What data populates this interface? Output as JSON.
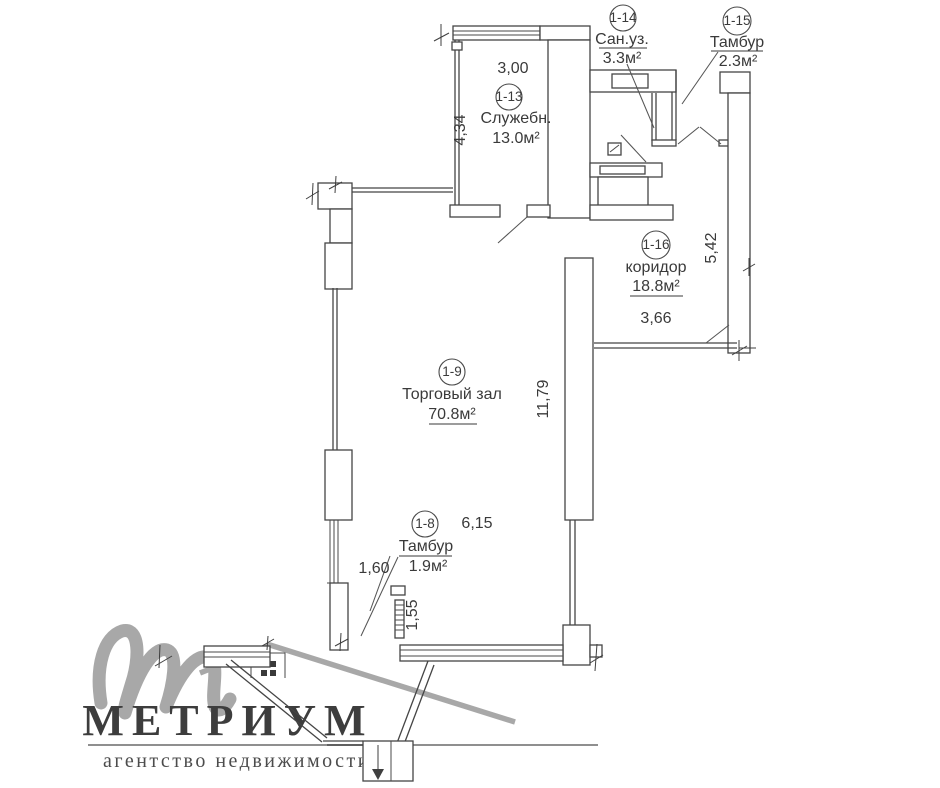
{
  "plan": {
    "rooms": [
      {
        "num": "1-13",
        "name": "Служебн.",
        "area": "13.0м²"
      },
      {
        "num": "1-14",
        "name": "Сан.уз.",
        "area": "3.3м²"
      },
      {
        "num": "1-15",
        "name": "Тамбур",
        "area": "2.3м²"
      },
      {
        "num": "1-16",
        "name": "коридор",
        "area": "18.8м²"
      },
      {
        "num": "1-9",
        "name": "Торговый зал",
        "area": "70.8м²"
      },
      {
        "num": "1-8",
        "name": "Тамбур",
        "area": "1.9м²"
      }
    ],
    "dims": {
      "top_width": "3,00",
      "left_height": "4,34",
      "right_height": "5,42",
      "corridor_width": "3,66",
      "hall_height": "11,79",
      "hall_width": "6,15",
      "left_window": "1,60",
      "entry_window": "1,55"
    }
  },
  "logo": {
    "brand": "МЕТРИУМ",
    "tagline": "агентство недвижимости"
  },
  "colors": {
    "background": "#ffffff",
    "plan_line": "#454545",
    "plan_text": "#3a3a3a",
    "logo_gray": "#a8a8a8",
    "brand_text": "#3d3d3d"
  }
}
